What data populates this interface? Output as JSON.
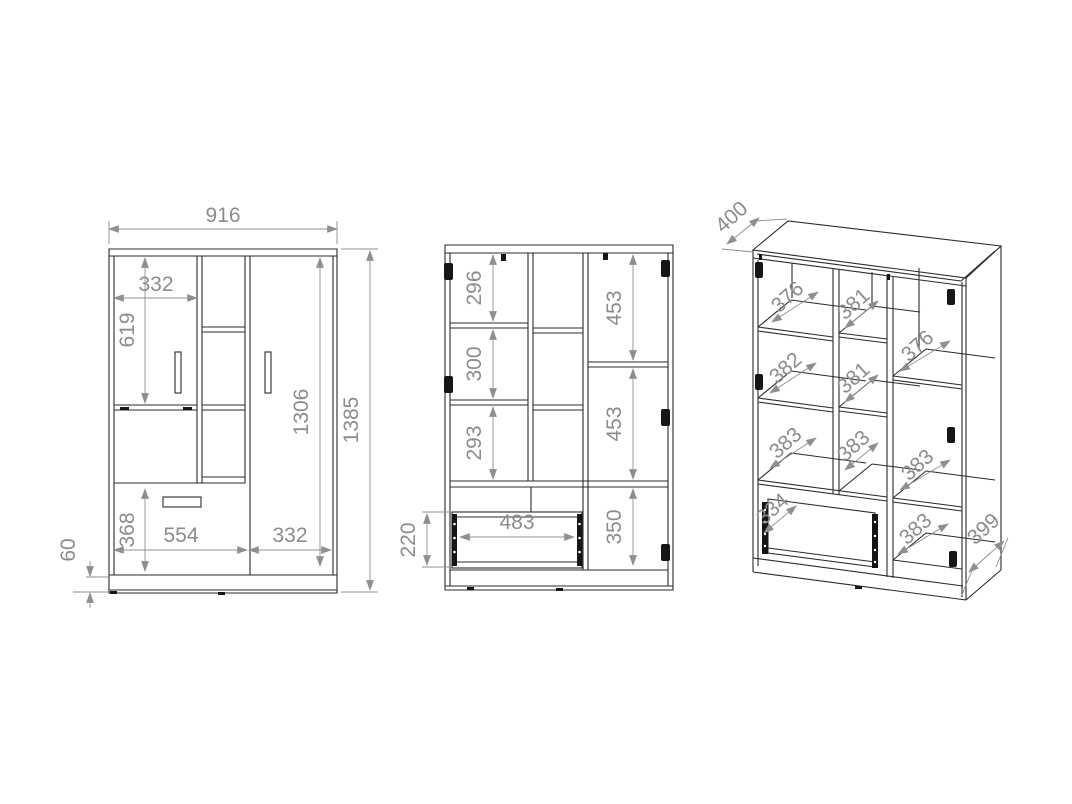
{
  "drawing": {
    "views": {
      "front": {
        "overall_width": "916",
        "left_door_width": "332",
        "left_door_height": "619",
        "right_door_height": "1306",
        "overall_height": "1385",
        "drawer_front_height": "368",
        "drawer_width": "554",
        "right_door_width": "332",
        "base_height": "60"
      },
      "interior": {
        "left_top_cell_height": "296",
        "left_middle_cell_height": "300",
        "left_bottom_cell_height": "293",
        "right_top_cell_height": "453",
        "right_middle_cell_height": "453",
        "right_bottom_cell_height": "350",
        "drawer_opening_width": "483",
        "drawer_box_height": "220"
      },
      "perspective": {
        "top_depth": "400",
        "shelf_left_top_depth": "376",
        "shelf_middle_top_depth": "381",
        "shelf_left_middle_depth": "382",
        "shelf_middle_middle_depth": "381",
        "shelf_right_top_depth": "376",
        "shelf_left_bottom_depth": "383",
        "shelf_middle_bottom_depth": "383",
        "shelf_right_middle_depth": "383",
        "drawer_depth": "334",
        "shelf_right_bottom_depth": "383",
        "base_depth": "399"
      }
    },
    "colors": {
      "line": "#2b2b2b",
      "dimension": "#8c8c8c"
    }
  }
}
